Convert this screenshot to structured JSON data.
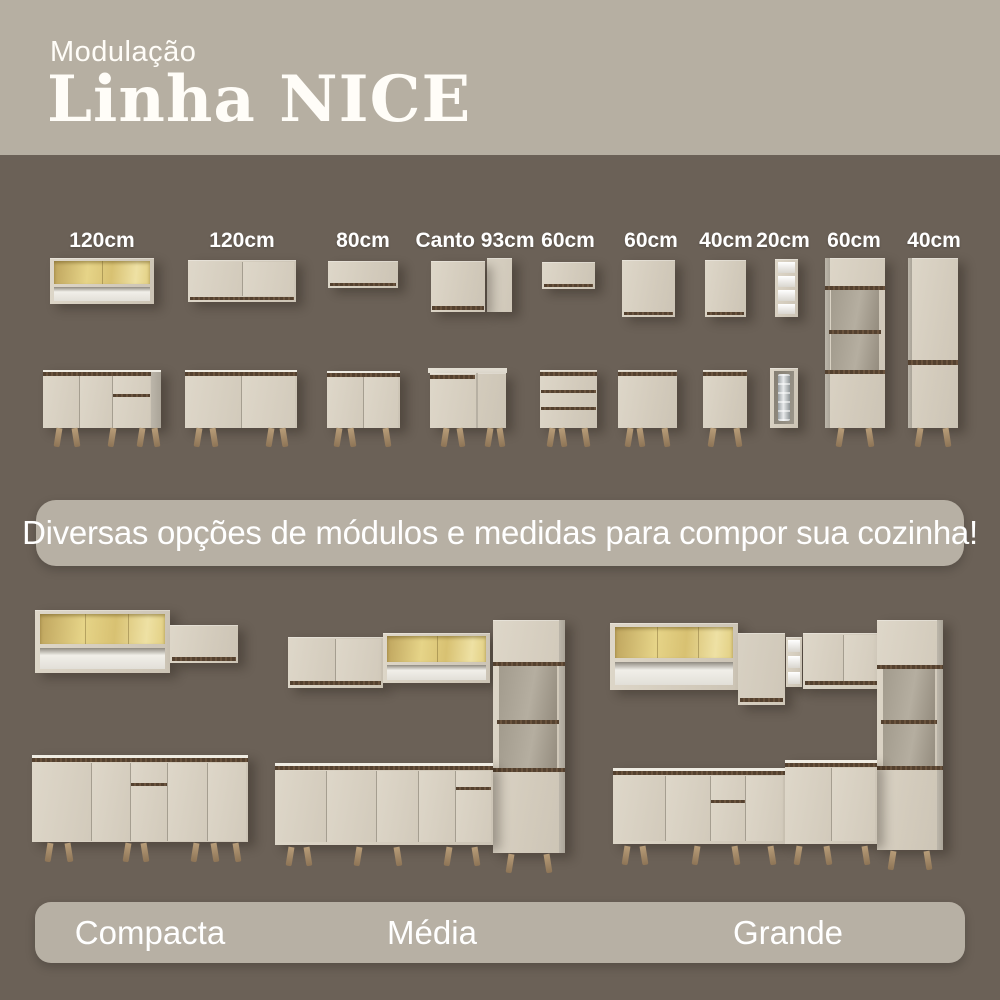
{
  "header": {
    "eyebrow": "Modulação",
    "title": "Linha NICE"
  },
  "modules": {
    "labels": [
      "120cm",
      "120cm",
      "80cm",
      "Canto 93cm",
      "60cm",
      "60cm",
      "40cm",
      "20cm",
      "60cm",
      "40cm"
    ]
  },
  "banner": {
    "text": "Diversas opções de módulos e medidas para compor sua cozinha!"
  },
  "kitchens": {
    "labels": [
      "Compacta",
      "Média",
      "Grande"
    ]
  },
  "palette": {
    "header_bg": "#b6afa2",
    "body_bg": "#6b6157",
    "pill_bg": "#b7b0a4",
    "text": "#ffffff",
    "cabinet": "#d6cec0",
    "wood_trim": "#5a4533",
    "legs": "#a8906d",
    "glass": "#e2cf82"
  }
}
